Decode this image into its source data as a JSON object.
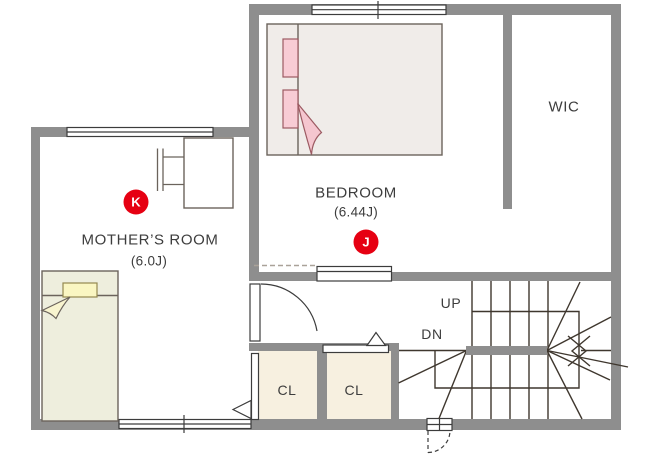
{
  "floor_plan": {
    "rooms": {
      "mothers_room": {
        "name": "MOTHER’S ROOM",
        "size": "(6.0J)"
      },
      "bedroom": {
        "name": "BEDROOM",
        "size": "(6.44J)"
      },
      "wic": {
        "name": "WIC"
      },
      "closet_1": {
        "name": "CL"
      },
      "closet_2": {
        "name": "CL"
      }
    },
    "stairs": {
      "up": "UP",
      "down": "DN"
    },
    "markers": {
      "k": "K",
      "j": "J"
    },
    "colors": {
      "wall_gray": "#8e8e8e",
      "marker_red": "#e60012",
      "closet_fill": "#f7f0e0",
      "bedroom_bed_fill": "#f0ece9",
      "bed_pink": "#f8ccd5",
      "blanket_pink": "#f5c6cf",
      "mothers_bed_fill": "#eeeedd",
      "pillow_yellow": "#faf6c2",
      "stair_line": "#3f372e",
      "text": "#3d3d3d"
    }
  }
}
